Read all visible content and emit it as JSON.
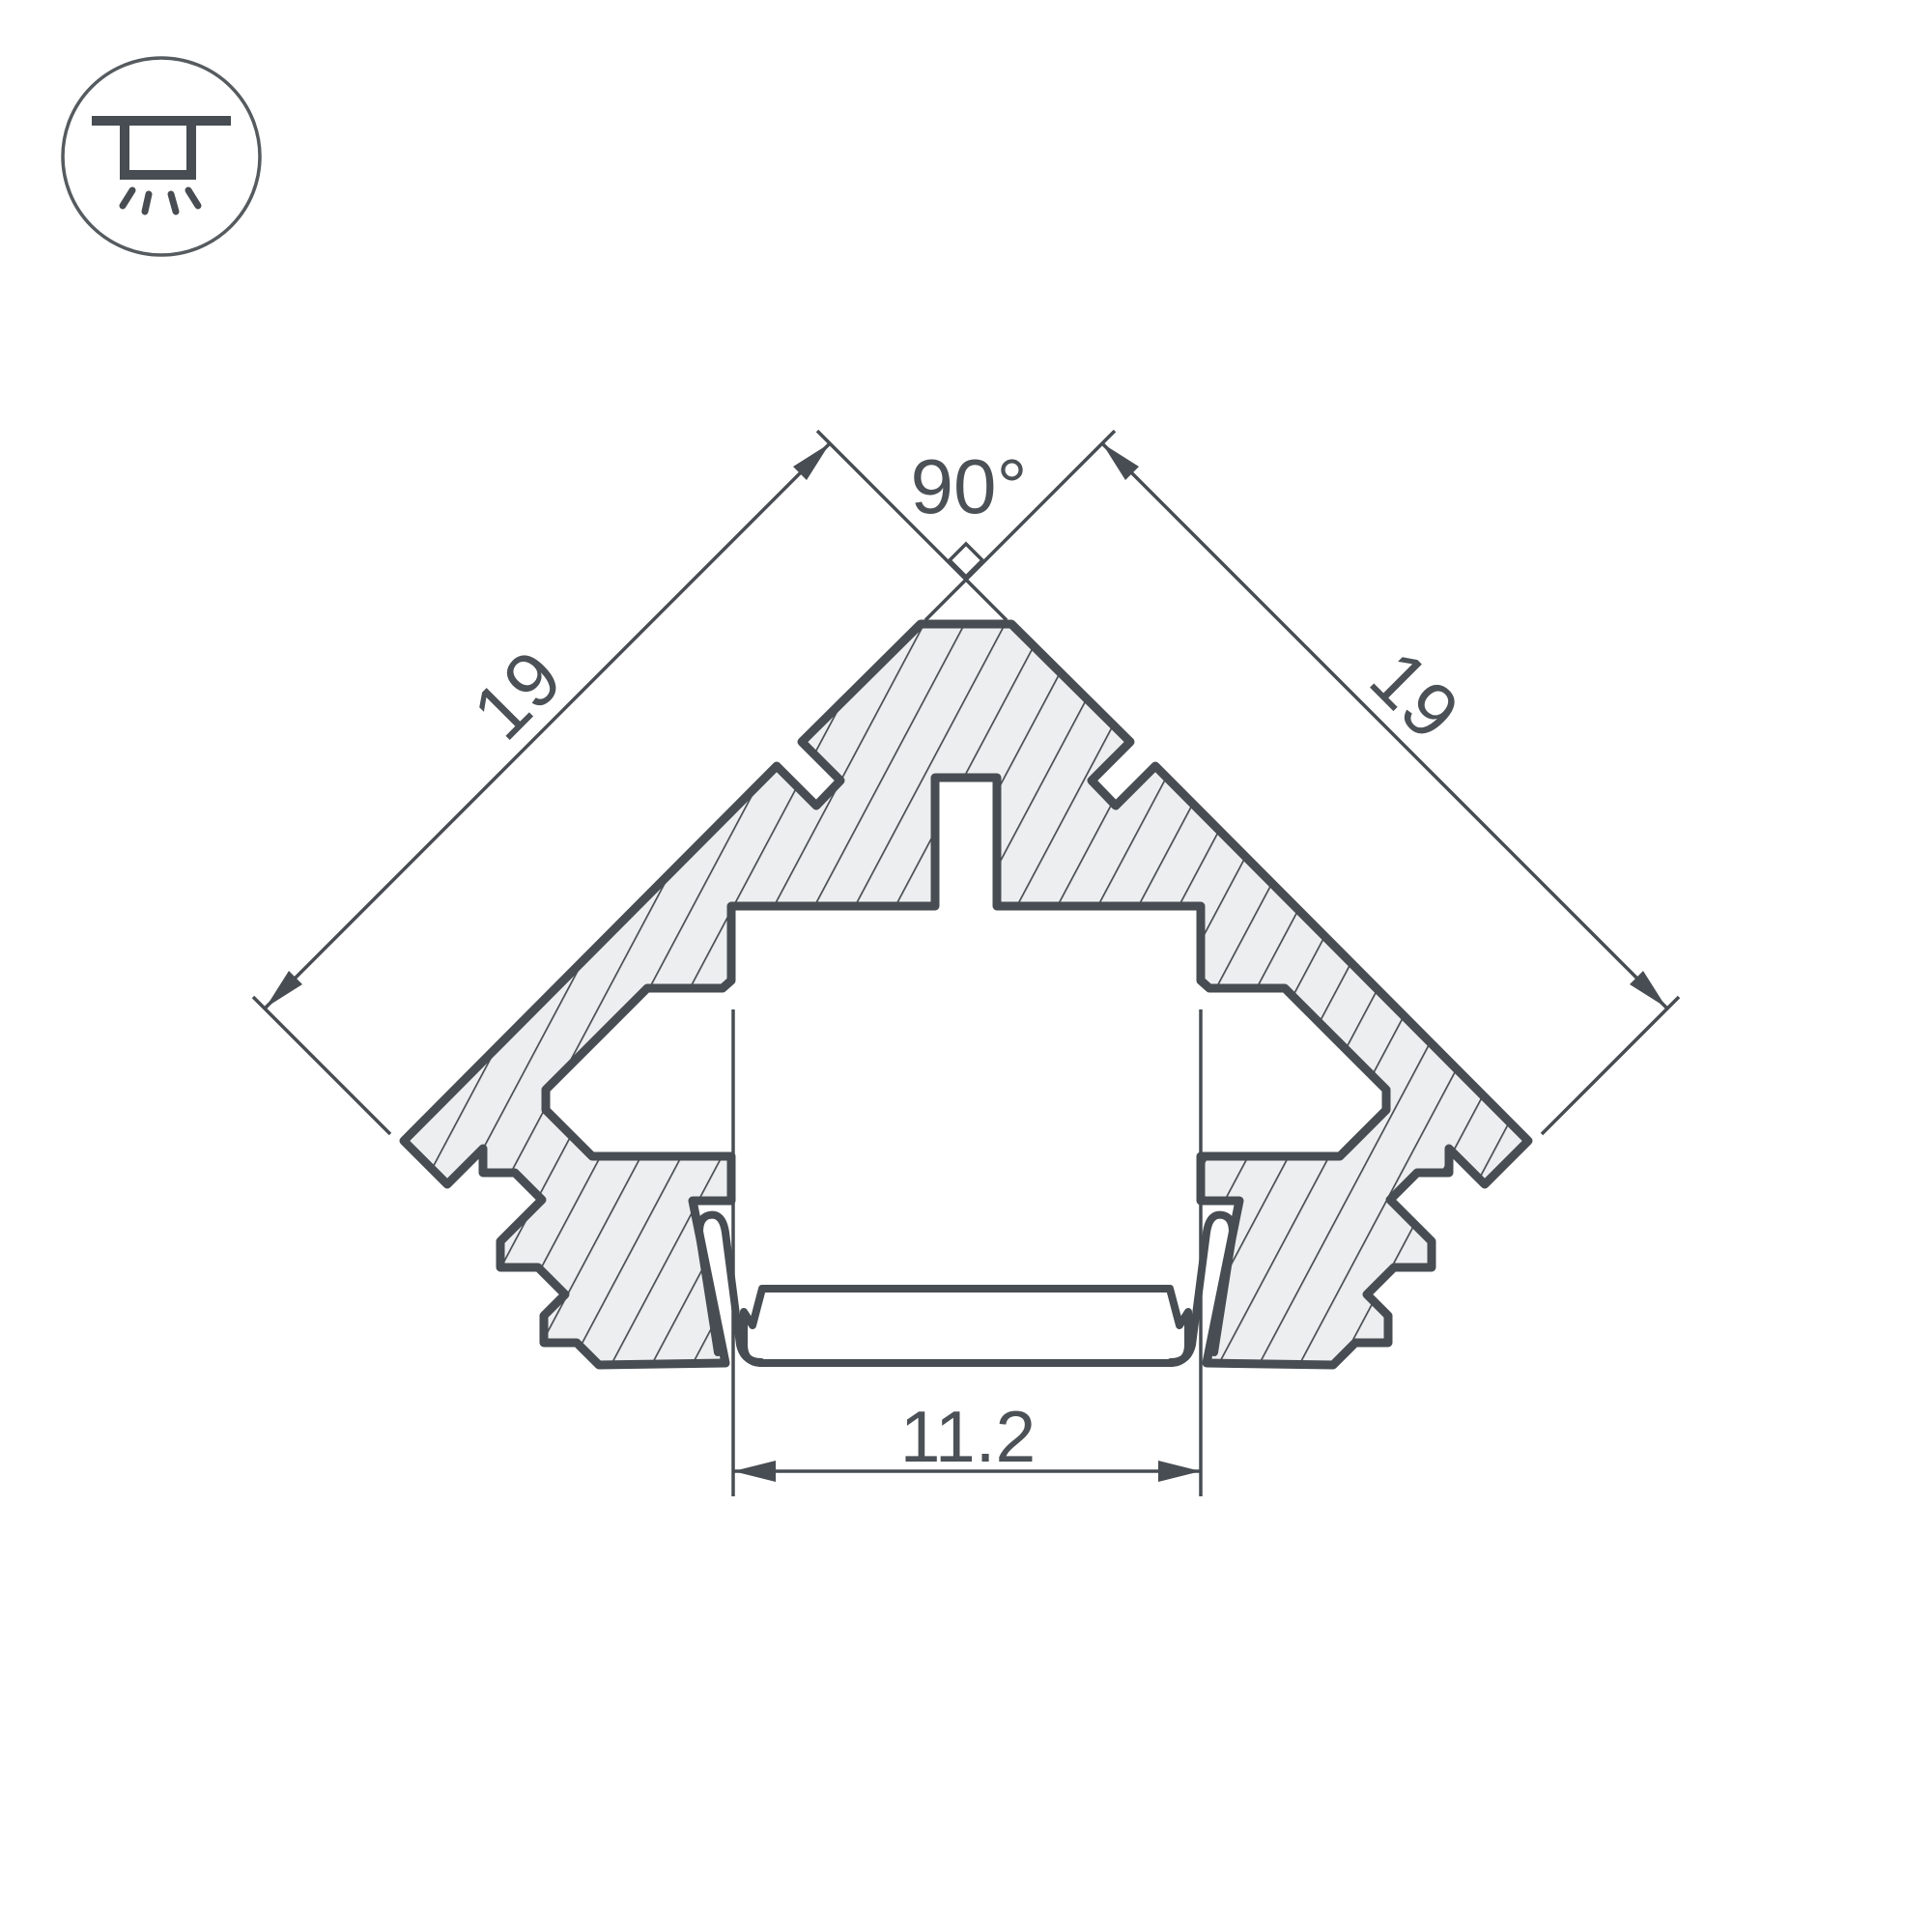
{
  "drawing": {
    "kind": "profile-cross-section",
    "dimensions": {
      "apex_angle": "90°",
      "left_side": "19",
      "right_side": "19",
      "opening_width": "11.2"
    },
    "colors": {
      "line": "#474d52",
      "text": "#4b5156",
      "hatch_fill": "#edeef0",
      "background": "#ffffff"
    },
    "icons": [
      {
        "name": "recessed-ceiling-light-icon"
      }
    ]
  }
}
